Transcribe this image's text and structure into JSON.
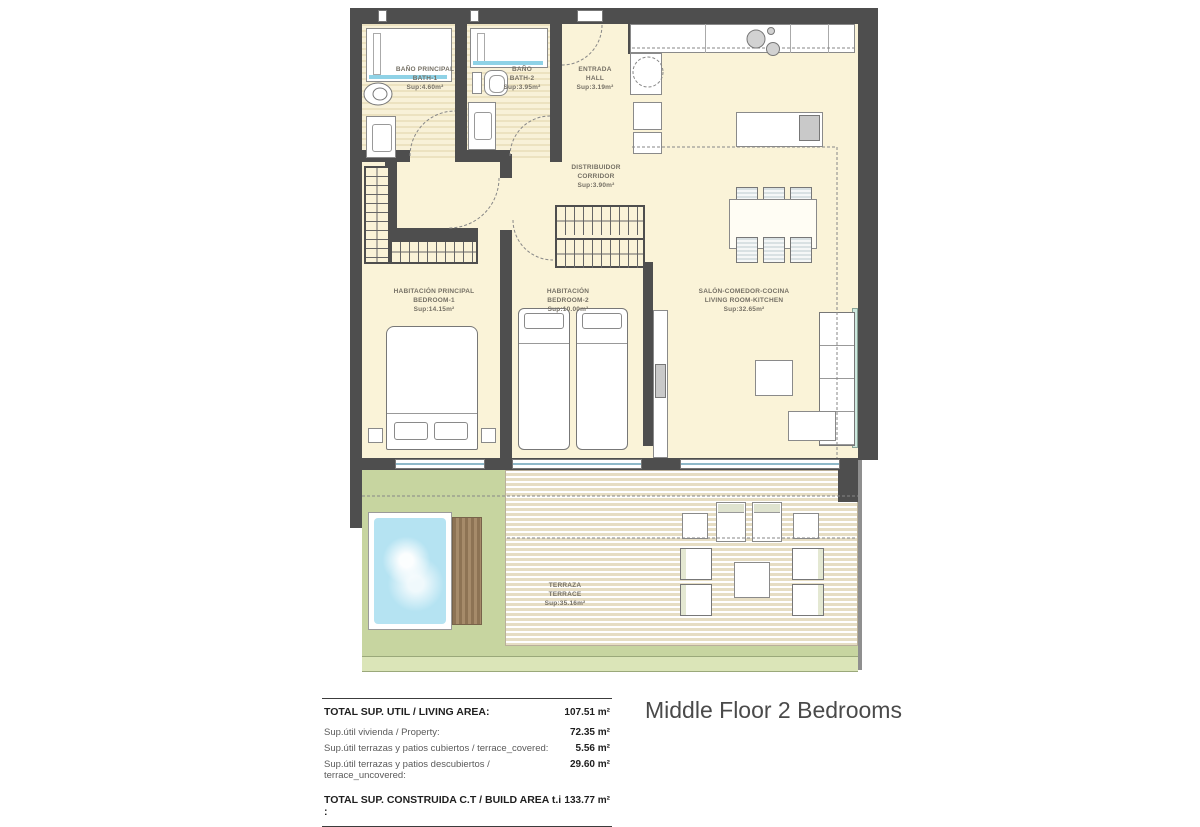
{
  "title": "Middle Floor 2 Bedrooms",
  "rooms": [
    {
      "id": "bath-1",
      "name_es": "BAÑO PRINCIPAL",
      "name_en": "BATH-1",
      "area": "Sup:4.60m²"
    },
    {
      "id": "bath-2",
      "name_es": "BAÑO",
      "name_en": "BATH-2",
      "area": "Sup:3.95m²"
    },
    {
      "id": "hall",
      "name_es": "ENTRADA",
      "name_en": "HALL",
      "area": "Sup:3.19m²"
    },
    {
      "id": "corridor",
      "name_es": "DISTRIBUIDOR",
      "name_en": "CORRIDOR",
      "area": "Sup:3.90m²"
    },
    {
      "id": "bedroom-1",
      "name_es": "HABITACIÓN PRINCIPAL",
      "name_en": "BEDROOM-1",
      "area": "Sup:14.15m²"
    },
    {
      "id": "bedroom-2",
      "name_es": "HABITACIÓN",
      "name_en": "BEDROOM-2",
      "area": "Sup:10.00m²"
    },
    {
      "id": "living-room",
      "name_es": "SALÓN-COMEDOR-COCINA",
      "name_en": "LIVING ROOM-KITCHEN",
      "area": "Sup:32.65m²"
    },
    {
      "id": "terrace",
      "name_es": "TERRAZA",
      "name_en": "TERRACE",
      "area": "Sup:35.16m²"
    }
  ],
  "summary": {
    "rows": [
      {
        "label": "TOTAL SUP. UTIL / LIVING AREA:",
        "value": "107.51 m²"
      },
      {
        "label": "Sup.útil vivienda / Property:",
        "value": "72.35 m²"
      },
      {
        "label": "Sup.útil terrazas y patios cubiertos / terrace_covered:",
        "value": "5.56 m²"
      },
      {
        "label": "Sup.útil terrazas y patios descubiertos / terrace_uncovered:",
        "value": "29.60 m²"
      },
      {
        "label": "TOTAL SUP. CONSTRUIDA C.T / BUILD AREA t.i :",
        "value": "133.77 m²"
      }
    ]
  },
  "colors": {
    "wall": "#4e4e4e",
    "floor": "#faf3d8",
    "terrace_green": "#c7d5a0",
    "pool_water": "#b5e3f2",
    "deck_stripe": "#e6ddc3",
    "glass": "#8fb9c9"
  }
}
